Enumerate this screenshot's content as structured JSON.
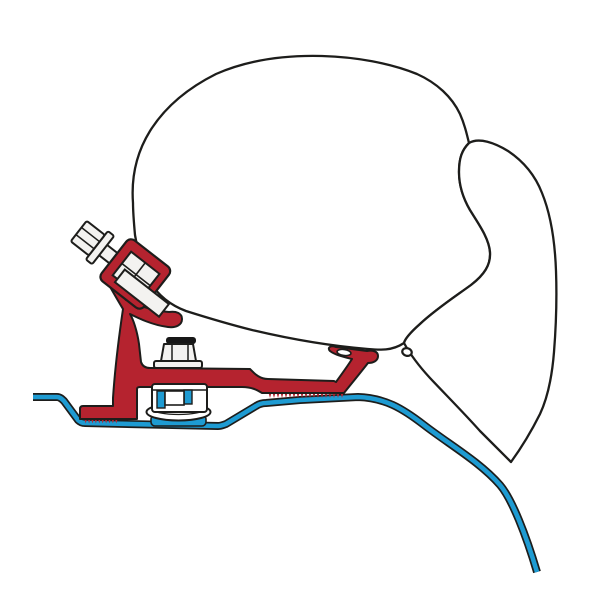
{
  "illustration": {
    "alt": "Side cross-section technical line drawing: awning case mounted above a van roof profile with a red adapter bracket, clamp bolts and serrated feet",
    "colors": {
      "background": "#ffffff",
      "outline": "#1d1d1b",
      "bracket_red": "#b5232f",
      "roof_blue": "#1e9bd2",
      "metal_white": "#ffffff",
      "metal_light": "#f3f2f0",
      "cap_dark": "#171717"
    }
  }
}
